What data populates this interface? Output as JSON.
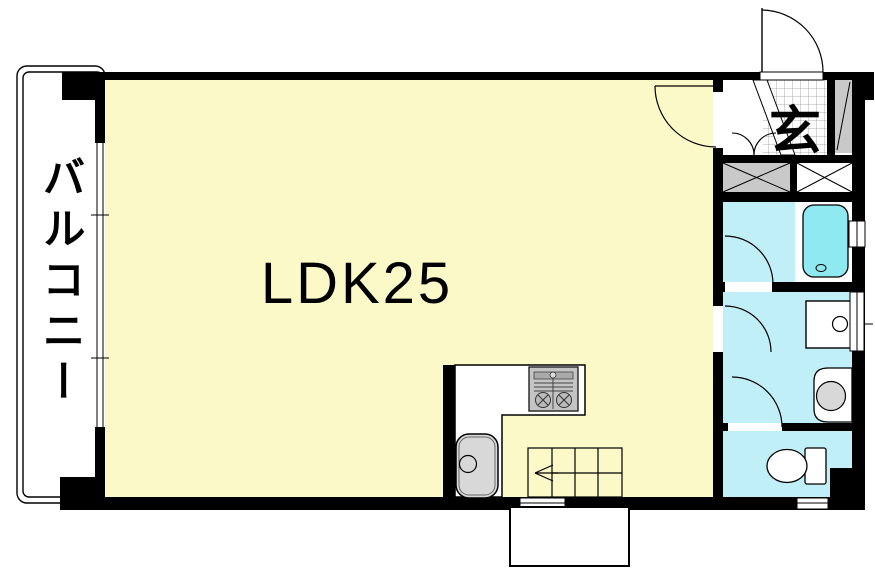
{
  "labels": {
    "ldk": "LDK25",
    "balcony": "バルコニー",
    "entrance": "玄"
  },
  "colors": {
    "wall": "#000000",
    "ldk_floor": "#FCF9C8",
    "wet_room": "#C1EFF7",
    "bathtub": "#8EE9F1",
    "fixture_gray": "#D8D8D8",
    "hatch_gray": "#C9C9C9",
    "stove_gray": "#C4C4C4"
  },
  "fixtures": [
    "entrance-door",
    "ldk-door",
    "closet-double-door",
    "bath-door",
    "washroom-door",
    "toilet-door",
    "bathtub",
    "washing-machine",
    "vanity-sink",
    "toilet",
    "kitchen-counter",
    "gas-stove",
    "kitchen-sink",
    "stairs",
    "balcony-window",
    "bath-window",
    "washroom-window",
    "shoe-cabinet",
    "pipe-space"
  ]
}
